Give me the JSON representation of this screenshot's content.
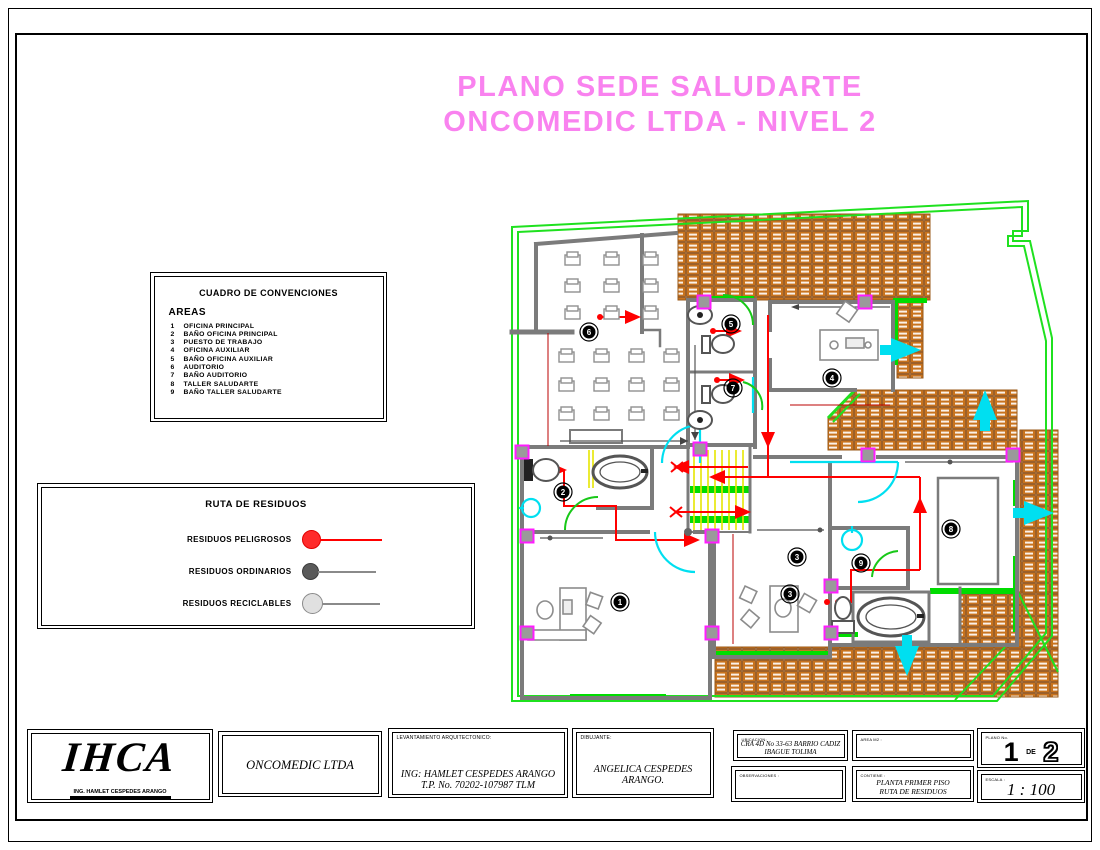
{
  "title": {
    "line1": "PLANO SEDE SALUDARTE",
    "line2": "ONCOMEDIC LTDA  -  NIVEL 2",
    "color": "#f982ef"
  },
  "conventions": {
    "title": "CUADRO DE CONVENCIONES",
    "subtitle": "AREAS",
    "items": [
      {
        "num": "1",
        "label": "OFICINA PRINCIPAL"
      },
      {
        "num": "2",
        "label": "BAÑO OFICINA PRINCIPAL"
      },
      {
        "num": "3",
        "label": "PUESTO DE TRABAJO"
      },
      {
        "num": "4",
        "label": "OFICINA AUXILIAR"
      },
      {
        "num": "5",
        "label": "BAÑO OFICINA AUXILIAR"
      },
      {
        "num": "6",
        "label": "AUDITORIO"
      },
      {
        "num": "7",
        "label": "BAÑO AUDITORIO"
      },
      {
        "num": "8",
        "label": "TALLER SALUDARTE"
      },
      {
        "num": "9",
        "label": "BAÑO TALLER SALUDARTE"
      }
    ]
  },
  "waste_legend": {
    "title": "RUTA DE RESIDUOS",
    "items": [
      {
        "label": "RESIDUOS PELIGROSOS",
        "dot_fill": "#ff2b2b",
        "dot_stroke": "#e00000",
        "line": "#ff0000",
        "dot_d": 17,
        "line_w": 62
      },
      {
        "label": "RESIDUOS ORDINARIOS",
        "dot_fill": "#5a5a5a",
        "dot_stroke": "#3c3c3c",
        "line": "#8a8a8a",
        "dot_d": 15,
        "line_w": 58
      },
      {
        "label": "RESIDUOS RECICLABLES",
        "dot_fill": "#e0e0e0",
        "dot_stroke": "#8a8a8a",
        "line": "#8a8a8a",
        "dot_d": 19,
        "line_w": 58
      }
    ]
  },
  "titleblock": {
    "logo_text": "IHCA",
    "logo_subtext": "ING. HAMLET CESPEDES ARANGO",
    "client": "ONCOMEDIC LTDA",
    "surveyor_header": "LEVANTAMIENTO ARQUITECTONICO:",
    "surveyor_line1": "ING: HAMLET CESPEDES ARANGO",
    "surveyor_line2": "T.P. No. 70202-107987  TLM",
    "draft_header": "DIBUJANTE:",
    "draft_name": "ANGELICA CESPEDES ARANGO.",
    "location_header": "UBICACION:",
    "location_line1": "CRA 4D No 33-63 BARRIO CADIZ",
    "location_line2": "IBAGUE TOLIMA",
    "area_header": "AREA M2 :",
    "notes_header": "OBSERVACIONES :",
    "contains_header": "CONTIENE :",
    "contains_line1": "PLANTA PRIMER PISO",
    "contains_line2": "RUTA DE RESIDUOS",
    "sheet_header": "PLANO No.",
    "sheet_current": "1",
    "sheet_sep": "DE",
    "sheet_total": "2",
    "scale_header": "ESCALA :",
    "scale_value": "1 : 100"
  },
  "plan": {
    "colors": {
      "boundary": "#1fe11f",
      "walls": "#7b7b7b",
      "route": "#ff0000",
      "terrace": "#c8731e",
      "door_arc": "#00dff0",
      "column": "#ff1cff",
      "stair": "#e6e600",
      "floor_strip": "#00dc00"
    },
    "room_markers": [
      {
        "num": "1",
        "x": 620,
        "y": 602
      },
      {
        "num": "2",
        "x": 563,
        "y": 492
      },
      {
        "num": "3",
        "x": 797,
        "y": 557
      },
      {
        "num": "3",
        "x": 790,
        "y": 594
      },
      {
        "num": "4",
        "x": 832,
        "y": 378
      },
      {
        "num": "5",
        "x": 731,
        "y": 324
      },
      {
        "num": "6",
        "x": 589,
        "y": 332
      },
      {
        "num": "7",
        "x": 733,
        "y": 388
      },
      {
        "num": "8",
        "x": 951,
        "y": 529
      },
      {
        "num": "9",
        "x": 861,
        "y": 563
      }
    ],
    "cyan_arrows": [
      {
        "x": 905,
        "y": 350,
        "dir": "right"
      },
      {
        "x": 985,
        "y": 406,
        "dir": "up"
      },
      {
        "x": 1038,
        "y": 513,
        "dir": "right"
      },
      {
        "x": 907,
        "y": 660,
        "dir": "down"
      }
    ],
    "columns": [
      {
        "x": 704,
        "y": 302
      },
      {
        "x": 865,
        "y": 302
      },
      {
        "x": 522,
        "y": 452
      },
      {
        "x": 700,
        "y": 449
      },
      {
        "x": 527,
        "y": 536
      },
      {
        "x": 712,
        "y": 536
      },
      {
        "x": 527,
        "y": 633
      },
      {
        "x": 712,
        "y": 633
      },
      {
        "x": 868,
        "y": 455
      },
      {
        "x": 1013,
        "y": 455
      },
      {
        "x": 831,
        "y": 586
      },
      {
        "x": 831,
        "y": 633
      }
    ],
    "chair_grids": [
      {
        "x": 565,
        "y": 252,
        "cols": 3,
        "rows": 3,
        "dx": 39,
        "dy": 27
      },
      {
        "x": 559,
        "y": 349,
        "cols": 4,
        "rows": 3,
        "dx": 35,
        "dy": 29
      }
    ]
  }
}
